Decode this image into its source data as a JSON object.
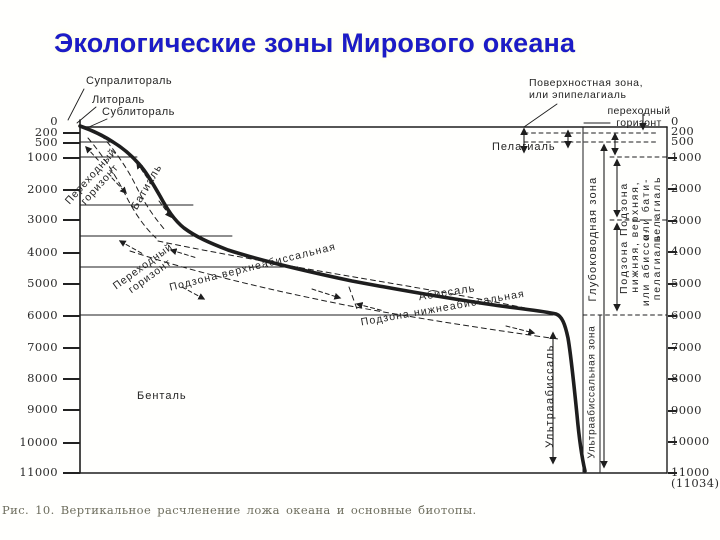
{
  "title": "Экологические зоны Мирового океана",
  "caption": "Рис. 10. Вертикальное расчленение ложа океана и основные биотопы.",
  "labels": {
    "supralittoral": "Супралитораль",
    "littoral": "Литораль",
    "sublittoral": "Сублитораль",
    "transition_horizon_upper": "Переходный\nгоризонт",
    "bathyal": "Батиаль",
    "transition_horizon_lower": "Переходный\nгоризонт",
    "subzone_upper_abyssal": "Подзона верхнеабиссальная",
    "abyssal": "Абиссаль",
    "subzone_lower_abyssal": "Подзона нижнеабиссальная",
    "ultraabyssal": "Ультраабиссаль",
    "benthal": "Бенталь",
    "pelagial": "Пелагиаль",
    "surface_zone": "Поверхностная зона,\nили эпипелагиаль",
    "transition_horizon_pelagic": "переходный\nгоризонт",
    "deepwater_zone": "Глубоководная зона",
    "pelagic_subzone_upper": "Подзона\nверхняя,\nили бати-\nпелагиаль",
    "pelagic_subzone_lower": "Подзона\nнижняя,\nили абиссо-\nпелагиаль",
    "ultraabyssal_zone": "Ультраабиссальная зона"
  },
  "axes": {
    "left": [
      {
        "label": "0",
        "y": 121,
        "tick": false
      },
      {
        "label": "200",
        "y": 132,
        "tick": true
      },
      {
        "label": "500",
        "y": 142,
        "tick": true
      },
      {
        "label": "1000",
        "y": 157,
        "tick": true
      },
      {
        "label": "2000",
        "y": 189,
        "tick": true
      },
      {
        "label": "3000",
        "y": 219,
        "tick": true
      },
      {
        "label": "4000",
        "y": 252,
        "tick": true
      },
      {
        "label": "5000",
        "y": 283,
        "tick": true
      },
      {
        "label": "6000",
        "y": 315,
        "tick": true
      },
      {
        "label": "7000",
        "y": 347,
        "tick": true
      },
      {
        "label": "8000",
        "y": 378,
        "tick": true
      },
      {
        "label": "9000",
        "y": 409,
        "tick": true
      },
      {
        "label": "10000",
        "y": 442,
        "tick": true
      },
      {
        "label": "11000",
        "y": 472,
        "tick": true
      }
    ],
    "right": [
      {
        "label": "0",
        "y": 121,
        "tick": false
      },
      {
        "label": "200",
        "y": 131,
        "tick": false
      },
      {
        "label": "500",
        "y": 141,
        "tick": false
      },
      {
        "label": "1000",
        "y": 157,
        "tick": true
      },
      {
        "label": "2000",
        "y": 188,
        "tick": true
      },
      {
        "label": "3000",
        "y": 220,
        "tick": true
      },
      {
        "label": "4000",
        "y": 251,
        "tick": true
      },
      {
        "label": "5000",
        "y": 283,
        "tick": true
      },
      {
        "label": "6000",
        "y": 315,
        "tick": true
      },
      {
        "label": "7000",
        "y": 347,
        "tick": true
      },
      {
        "label": "8000",
        "y": 378,
        "tick": true
      },
      {
        "label": "9000",
        "y": 410,
        "tick": true
      },
      {
        "label": "10000",
        "y": 441,
        "tick": true
      },
      {
        "label": "11000",
        "y": 472,
        "tick": true
      },
      {
        "label": "(11034)",
        "y": 483,
        "tick": false
      }
    ]
  },
  "colors": {
    "title_blue": "#1c1cc6",
    "ink": "#1e1e1e",
    "caption_gray": "#6e6e5e"
  }
}
